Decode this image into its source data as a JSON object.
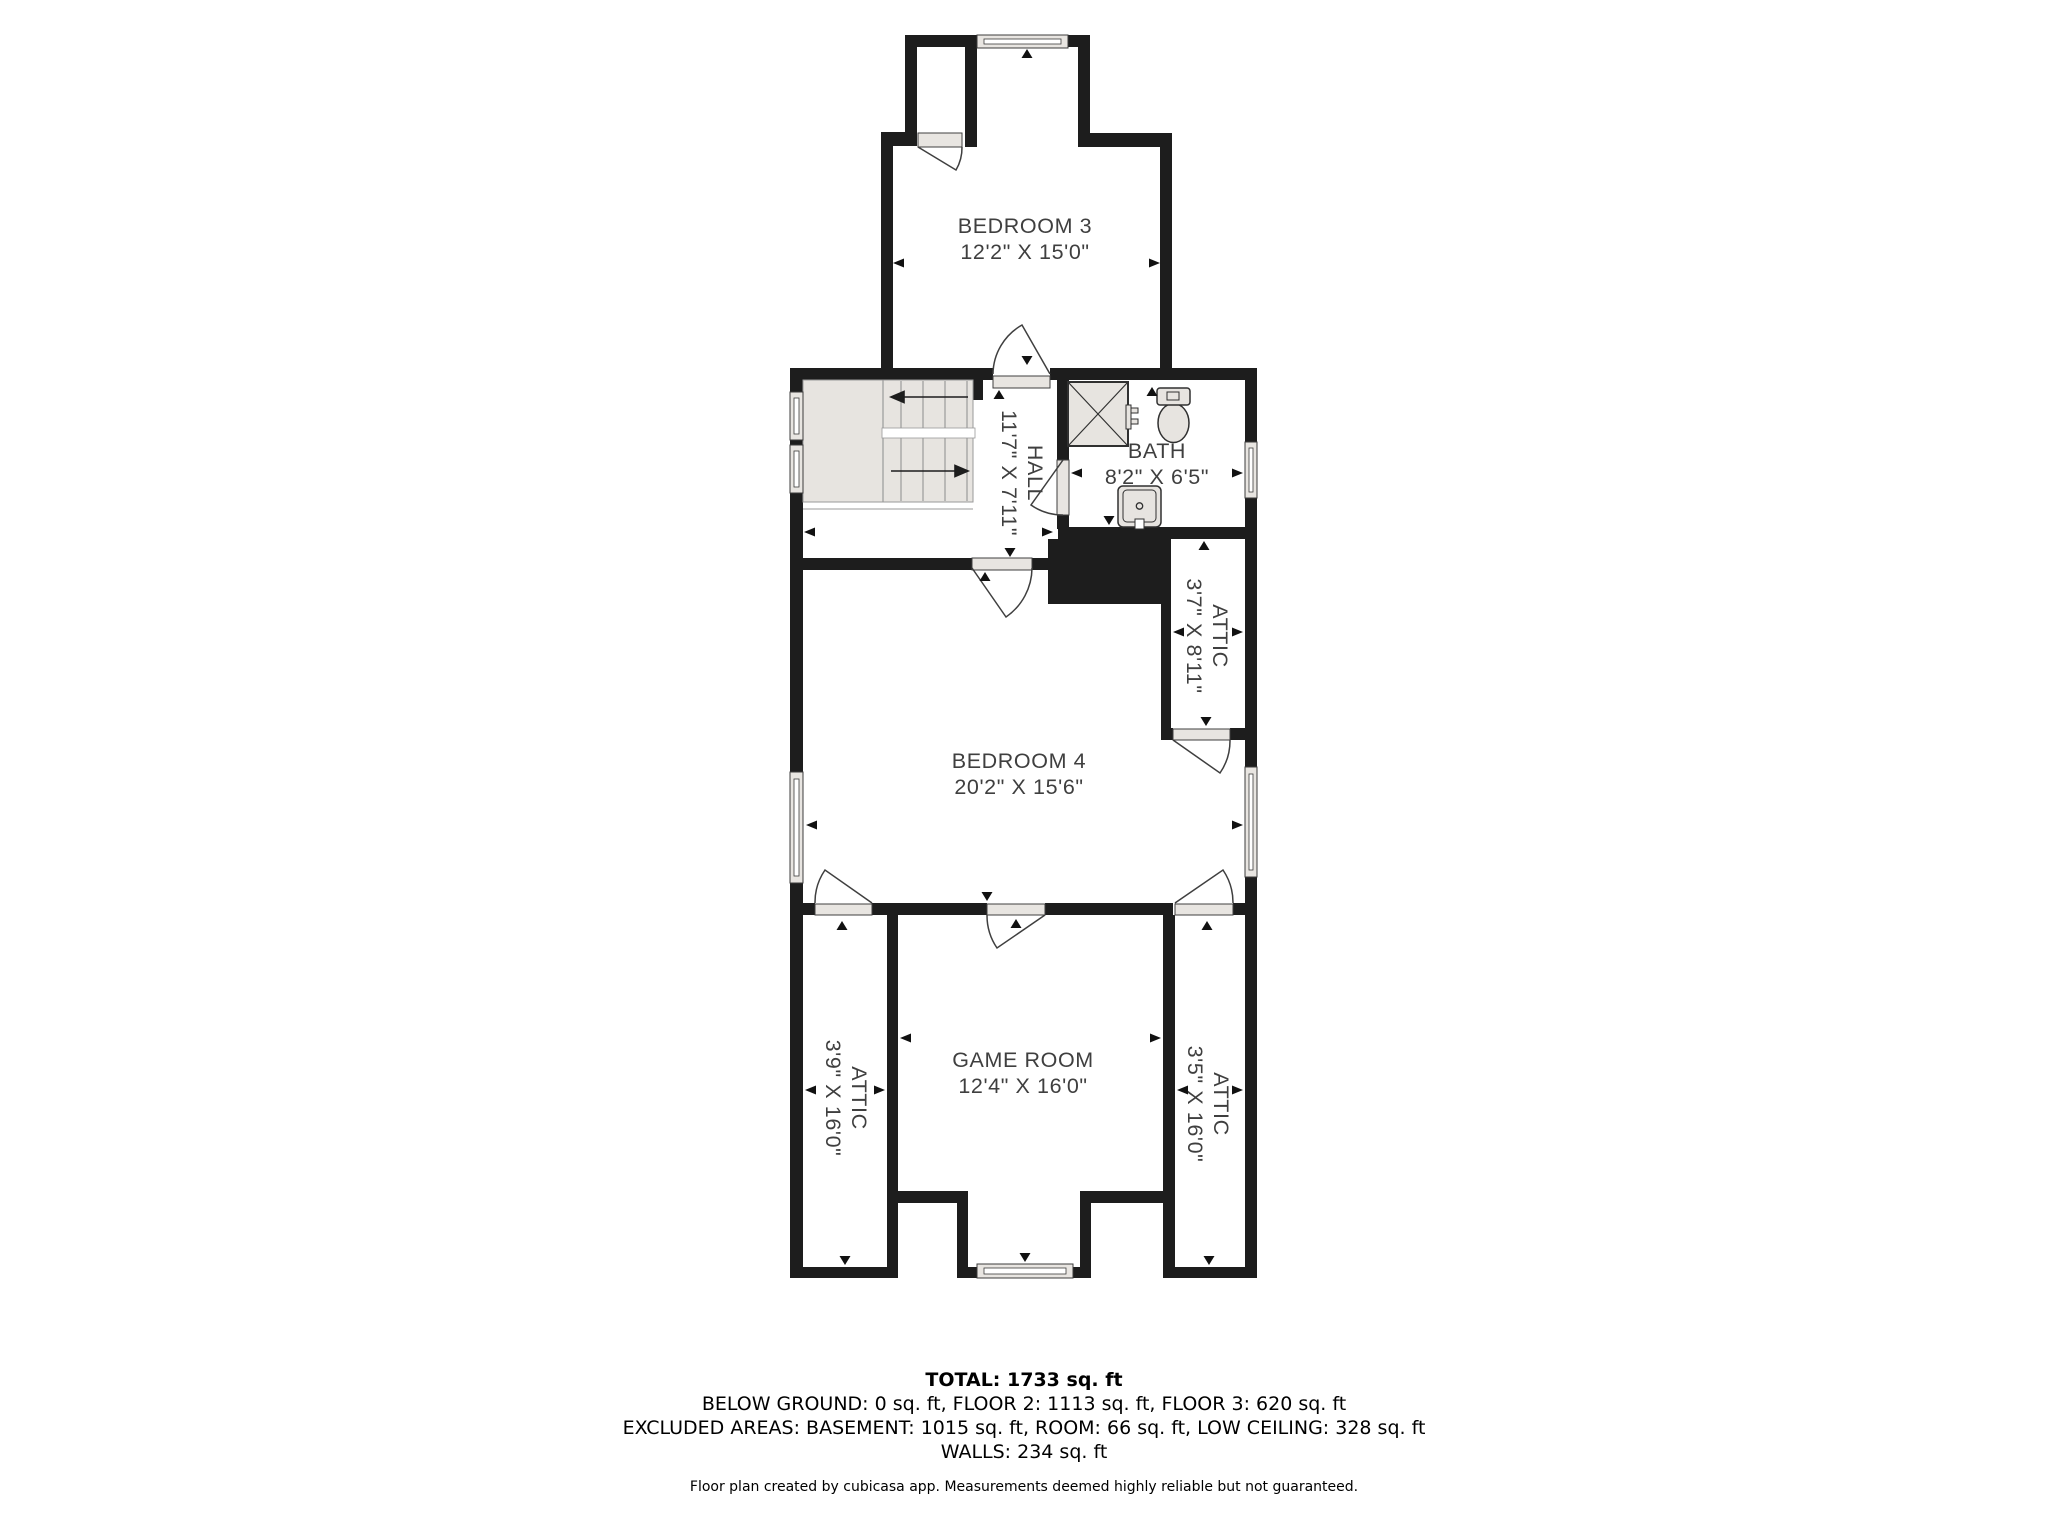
{
  "floor_plan": {
    "rooms": [
      {
        "id": "bedroom-3",
        "name": "BEDROOM 3",
        "dims": "12'2\" X 15'0\""
      },
      {
        "id": "hall",
        "name": "HALL",
        "dims": "11'7\" X 7'11\""
      },
      {
        "id": "bath",
        "name": "BATH",
        "dims": "8'2\" X 6'5\""
      },
      {
        "id": "attic-upper",
        "name": "ATTIC",
        "dims": "3'7\" X 8'11\""
      },
      {
        "id": "bedroom-4",
        "name": "BEDROOM 4",
        "dims": "20'2\" X 15'6\""
      },
      {
        "id": "attic-left",
        "name": "ATTIC",
        "dims": "3'9\" X 16'0\""
      },
      {
        "id": "game-room",
        "name": "GAME ROOM",
        "dims": "12'4\" X 16'0\""
      },
      {
        "id": "attic-right",
        "name": "ATTIC",
        "dims": "3'5\" X 16'0\""
      }
    ]
  },
  "summary": {
    "total": "TOTAL: 1733 sq. ft",
    "floors": "BELOW GROUND: 0 sq. ft, FLOOR 2: 1113 sq. ft, FLOOR 3: 620 sq. ft",
    "excluded": "EXCLUDED AREAS: BASEMENT: 1015 sq. ft, ROOM: 66 sq. ft, LOW CEILING: 328 sq. ft",
    "walls": "WALLS: 234 sq. ft"
  },
  "disclaimer": "Floor plan created by cubicasa app. Measurements deemed highly reliable but not guaranteed.",
  "colors": {
    "wall": "#1d1d1d",
    "fixture_fill": "#e8e5e1",
    "label_text": "#3f3f3f"
  }
}
